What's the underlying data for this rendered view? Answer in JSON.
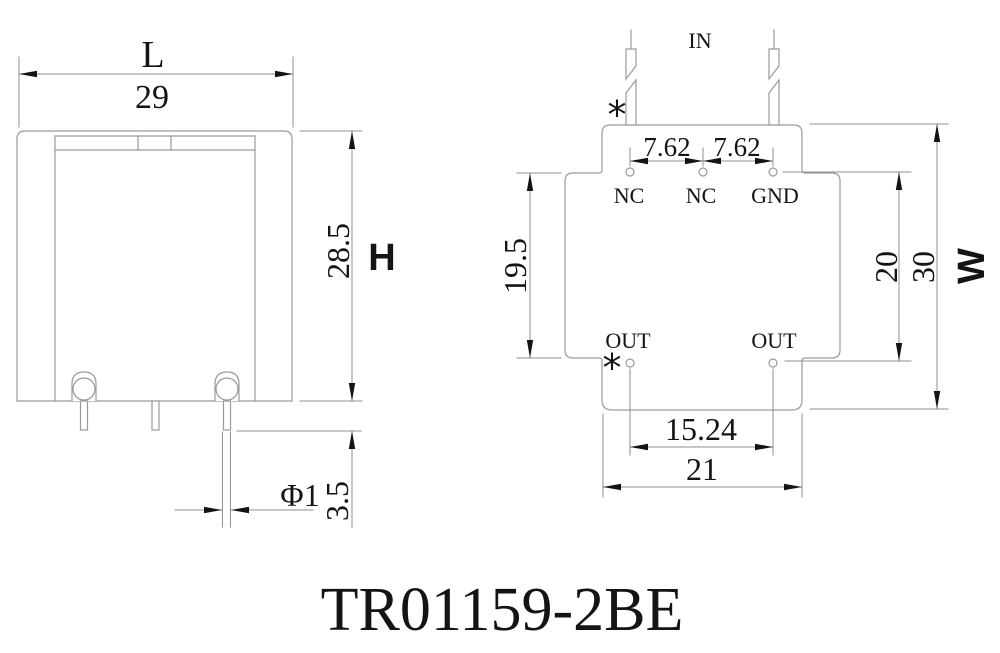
{
  "colors": {
    "background": "#ffffff",
    "line": "#9a9a9a",
    "ink": "#141414"
  },
  "title": "TR01159-2BE",
  "front_view": {
    "width_label": "L",
    "width_value": "29",
    "height_label": "H",
    "height_value": "28.5",
    "pin_length_value": "3.5",
    "pin_diameter_value": "Φ1"
  },
  "bottom_view": {
    "in_label": "IN",
    "polarity_mark_top": "*",
    "polarity_mark_bottom": "*",
    "pin_labels": {
      "nc_left": "NC",
      "nc_mid": "NC",
      "gnd": "GND",
      "out_left": "OUT",
      "out_right": "OUT"
    },
    "pitch_left_value": "7.62",
    "pitch_right_value": "7.62",
    "inner_height_value": "19.5",
    "pin_row_span_value": "20",
    "outline_height_value": "30",
    "width_label": "W",
    "out_pitch_value": "15.24",
    "base_width_value": "21"
  }
}
